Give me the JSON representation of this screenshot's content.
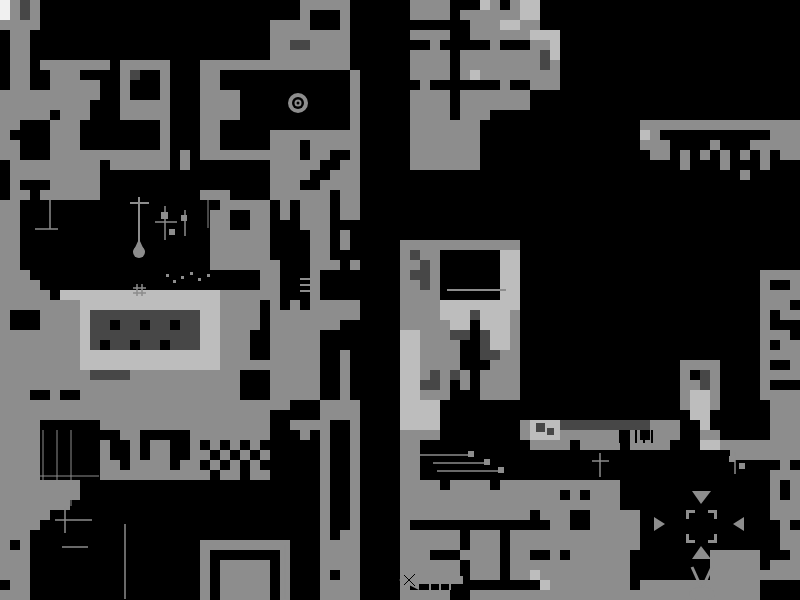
{
  "map": {
    "label": "monochrome game world map",
    "canvas_width": 800,
    "canvas_height": 600,
    "cell": 10,
    "palette": {
      ".": "#000000",
      "k": "#000000",
      "g": "#8d8d8d",
      "l": "#bdbdbd",
      "d": "#474747",
      "w": "#f0f0f0"
    },
    "grid": [
      "wgdg..........................ggggg......gggg...lg.gll..........................",
      "wgdg..........................g...g......gggg.ggggggll..........................",
      "gggg.......................gggg...g............gggllgg..........................",
      ".gg........................gggggggg......gggg..gggggglll........................",
      ".gg........................ggddgggg........g.....g...ggl........................",
      ".gg........................gggggggg......gggg.ggggggggdl........................",
      ".gg.ggggggg.ggggg...ggggggggggggggg......gggg.ggggggggdg........................",
      ".gg..ggg....gd..g...gg.............g.....gggg.glgggggggg........................",
      ".gg..ggggg..g...g...gg.............g......g.......g..ggg........................",
      "gggggggggg..g...g...gggg...........g.....gggg.ggggggg...........................",
      "ggggggggg...ggggg...gggg...........g.....gggg.ggggggg...........................",
      "ggggg.ggg...ggggg...gggg...........g.....gggg.ggg...............................",
      "gg...ggg........g...gg.............g.....ggggggg................gggggggggggggggg",
      "g....ggg........g...gg.....ggggggggg.....ggggggg................lg...........ggg",
      "gg...ggg........g...gg.....ggg.ggggg.....ggggggg................ggg....g...ggggg",
      "gg...gggggggggggg.g.gggggggggg.gg..g.....ggggggg.................gg.g.g.g.g.g.gg",
      ".ggggggggg.gggggg.g........ggggg..gg.....ggggggg....................g...g...g...",
      ".ggggggggg.................gggg..ggg......................................g.....",
      ".g...ggggg.................ggg..gggg............................................",
      ".gg.gggggg..........ggg....gggggg.gg............................................",
      "gg....................ggggg.g.ggg.gg............................................",
      "gg...................gg..gg.g.ggg.gg............................................",
      "gg...................gg..gg...ggg...............................................",
      "gg...................gggggg....gg.g.............................................",
      "gg...................gggggg....gg.g.....gggggggggggg............................",
      "gg...................gggggg....gg.......gdgg......ll............................",
      "gg...................ggggggg...ggg.g....ggdg......ll............................",
      "ggg.......................gg...g........gddg......ll........................gggg",
      "gggg......................gg...g........ggdg......ll........................g..g",
      "ggggg.llllllllllllllllgggggg...g........gggg......ll........................gggg",
      "ggggggggllllllllllllllgggg.g.g.ggggg....ggggllllllll........................ggg.",
      "g...ggggldddddddddddllgggg.ggggggggg....ggggllldlllg........................g.gg",
      "g...ggggldd.dd.dd.ddllgggg.ggggggg......gggggll.lllg........................g...",
      "ggggggggldddddddddddllggg..ggggg........llgggdd.dllg........................ggg.",
      "ggggggggld.dd.dd.dddllggg..ggggg........llgggg..dllg........................g.gg",
      "ggggggggllllllllllllllggg..ggggg..g.....llgggg..ddgg........................gggg",
      "ggggggggllllllllllllllgggggggggg..g.....llgggg...ggg................gggg....g..g",
      "gggggggggddddggggggggggg...ggggg..g.....llgdgdg.gggg................g.dg....gggg",
      "gggggggggggggggggggggggg...ggggg..g.....llddg.g.gggg................ggdg....g...",
      "ggg..g..gggggggggggggggg...ggggg..g.....llggg...gggg................gllg....gggg",
      "ggggggggggggggggggggggggggggg...gggg....llll........................gllg.....ggg",
      "ggggggggggggggggggggggggggg.....gggg....llll.........................ll......ggg",
      "gggg......ggggggggggggggggg..gggg..g....llll........gllldddddddddggg..l......ggg",
      "gggg........gg.....gggggggg...g.g..g....gggg........glllgggggg.g.ggg..gg.....ggg",
      "gggg......g..g.gg..g.g.g.g......g..g....gg...........gggg.gggg.gggg...llgggggggg",
      "gggg......g..g.gg..gg.g.g.g.....g..g....gg...............................ggggggg",
      "gggg......gg.gggg.gg.g.g.g......g..g....gg....................................g.",
      "gggg......ggggggggggg.gg.gg.....g..g....gg...................................ggg",
      "gggggggg........................g..g....gggg.gggg.gggggggggggg...............g.g",
      "gggggggg........................g..g....gggggggggggggggg.g.ggg...............g.g",
      "ggggggg.........................g..g....gggggggggggggggggggggg...............ggg",
      "ggggg...........................g..g....ggggggggggggg.ggg..ggggg.............ggg",
      "gggg............................g..g....g..............gg..ggggg..............g.",
      "ggg.............................g.gg....gggggg.ggg.ggggggggggggg..............gg",
      "g.g.................ggggggggg...gggg....gggggg.ggg.ggggggggggggg..............gg",
      "ggg.................g.......g...gggg....ggg...gggg.gg..g.gggggg........ggggg...g",
      "ggg.................g.ggggg.g...gggg....gggggg.ggg.gggggggggggg........ggggg.ggg",
      "ggg.................g.ggggg.g...g.gg....gggggg.ggg.gglggggggggg........ggggggggg",
      ".gg.................g.ggggg.g...gggg....g.............lgggggggg.gggggggggggg....",
      "ggg.................g.ggggg.g...gggg....ggggg..ggggggggggggggggggggggggggggg...."
    ],
    "features": [
      {
        "t": "circle",
        "cx": 298,
        "cy": 103,
        "r": 10,
        "c": "g"
      },
      {
        "t": "circle",
        "cx": 298,
        "cy": 103,
        "r": 6,
        "c": "k"
      },
      {
        "t": "circle",
        "cx": 298,
        "cy": 103,
        "r": 3.5,
        "c": "g"
      },
      {
        "t": "circle",
        "cx": 298,
        "cy": 103,
        "r": 1.5,
        "c": "k"
      },
      {
        "t": "line",
        "x1": 139,
        "y1": 197,
        "x2": 139,
        "y2": 244,
        "w": 2,
        "c": "g"
      },
      {
        "t": "line",
        "x1": 130,
        "y1": 203,
        "x2": 149,
        "y2": 203,
        "w": 2,
        "c": "g"
      },
      {
        "t": "tri",
        "p": [
          [
            139,
            239
          ],
          [
            133,
            252
          ],
          [
            145,
            252
          ]
        ],
        "c": "g"
      },
      {
        "t": "circle",
        "cx": 139,
        "cy": 252,
        "r": 6,
        "c": "g"
      },
      {
        "t": "line",
        "x1": 50,
        "y1": 200,
        "x2": 50,
        "y2": 229,
        "w": 1.5,
        "c": "g"
      },
      {
        "t": "line",
        "x1": 35,
        "y1": 229,
        "x2": 58,
        "y2": 229,
        "w": 1.5,
        "c": "g"
      },
      {
        "t": "line",
        "x1": 165,
        "y1": 206,
        "x2": 165,
        "y2": 240,
        "w": 1.5,
        "c": "g"
      },
      {
        "t": "line",
        "x1": 155,
        "y1": 222,
        "x2": 177,
        "y2": 222,
        "w": 1.5,
        "c": "g"
      },
      {
        "t": "rect",
        "x": 161,
        "y": 212,
        "wd": 7,
        "ht": 7,
        "c": "g"
      },
      {
        "t": "rect",
        "x": 169,
        "y": 229,
        "wd": 6,
        "ht": 6,
        "c": "g"
      },
      {
        "t": "line",
        "x1": 185,
        "y1": 210,
        "x2": 185,
        "y2": 236,
        "w": 1.5,
        "c": "g"
      },
      {
        "t": "rect",
        "x": 181,
        "y": 215,
        "wd": 6,
        "ht": 6,
        "c": "g"
      },
      {
        "t": "line",
        "x1": 208,
        "y1": 200,
        "x2": 208,
        "y2": 228,
        "w": 1,
        "c": "g"
      },
      {
        "t": "rect",
        "x": 166,
        "y": 274,
        "wd": 3,
        "ht": 3,
        "c": "g"
      },
      {
        "t": "rect",
        "x": 173,
        "y": 280,
        "wd": 3,
        "ht": 3,
        "c": "g"
      },
      {
        "t": "rect",
        "x": 181,
        "y": 276,
        "wd": 3,
        "ht": 3,
        "c": "g"
      },
      {
        "t": "rect",
        "x": 190,
        "y": 272,
        "wd": 3,
        "ht": 3,
        "c": "g"
      },
      {
        "t": "rect",
        "x": 198,
        "y": 278,
        "wd": 3,
        "ht": 3,
        "c": "g"
      },
      {
        "t": "rect",
        "x": 207,
        "y": 274,
        "wd": 3,
        "ht": 3,
        "c": "g"
      },
      {
        "t": "line",
        "x1": 137,
        "y1": 284,
        "x2": 137,
        "y2": 296,
        "w": 1.5,
        "c": "g"
      },
      {
        "t": "line",
        "x1": 142,
        "y1": 284,
        "x2": 142,
        "y2": 296,
        "w": 1.5,
        "c": "g"
      },
      {
        "t": "line",
        "x1": 133,
        "y1": 288,
        "x2": 146,
        "y2": 288,
        "w": 1.5,
        "c": "g"
      },
      {
        "t": "line",
        "x1": 133,
        "y1": 293,
        "x2": 146,
        "y2": 293,
        "w": 1.5,
        "c": "g"
      },
      {
        "t": "line",
        "x1": 300,
        "y1": 279,
        "x2": 317,
        "y2": 279,
        "w": 2,
        "c": "g"
      },
      {
        "t": "line",
        "x1": 300,
        "y1": 285,
        "x2": 317,
        "y2": 285,
        "w": 2,
        "c": "g"
      },
      {
        "t": "line",
        "x1": 300,
        "y1": 291,
        "x2": 317,
        "y2": 291,
        "w": 2,
        "c": "g"
      },
      {
        "t": "line",
        "x1": 447,
        "y1": 290,
        "x2": 506,
        "y2": 290,
        "w": 2,
        "c": "g"
      },
      {
        "t": "line",
        "x1": 420,
        "y1": 455,
        "x2": 470,
        "y2": 455,
        "w": 1.5,
        "c": "g"
      },
      {
        "t": "rect",
        "x": 468,
        "y": 451,
        "wd": 6,
        "ht": 6,
        "c": "g"
      },
      {
        "t": "line",
        "x1": 433,
        "y1": 463,
        "x2": 487,
        "y2": 463,
        "w": 1.5,
        "c": "g"
      },
      {
        "t": "rect",
        "x": 484,
        "y": 459,
        "wd": 6,
        "ht": 6,
        "c": "g"
      },
      {
        "t": "line",
        "x1": 437,
        "y1": 471,
        "x2": 502,
        "y2": 471,
        "w": 1.5,
        "c": "g"
      },
      {
        "t": "rect",
        "x": 498,
        "y": 467,
        "wd": 6,
        "ht": 6,
        "c": "g"
      },
      {
        "t": "line",
        "x1": 43,
        "y1": 430,
        "x2": 43,
        "y2": 506,
        "w": 1,
        "c": "g"
      },
      {
        "t": "line",
        "x1": 57,
        "y1": 430,
        "x2": 57,
        "y2": 509,
        "w": 1,
        "c": "g"
      },
      {
        "t": "line",
        "x1": 71,
        "y1": 430,
        "x2": 71,
        "y2": 506,
        "w": 1,
        "c": "g"
      },
      {
        "t": "line",
        "x1": 34,
        "y1": 476,
        "x2": 99,
        "y2": 476,
        "w": 1,
        "c": "g"
      },
      {
        "t": "line",
        "x1": 65,
        "y1": 506,
        "x2": 65,
        "y2": 533,
        "w": 1.5,
        "c": "g"
      },
      {
        "t": "line",
        "x1": 55,
        "y1": 520,
        "x2": 92,
        "y2": 520,
        "w": 1.5,
        "c": "g"
      },
      {
        "t": "line",
        "x1": 125,
        "y1": 524,
        "x2": 125,
        "y2": 599,
        "w": 1.5,
        "c": "g"
      },
      {
        "t": "line",
        "x1": 62,
        "y1": 547,
        "x2": 88,
        "y2": 547,
        "w": 1.5,
        "c": "g"
      },
      {
        "t": "line",
        "x1": 285,
        "y1": 545,
        "x2": 285,
        "y2": 599,
        "w": 1.5,
        "c": "g"
      },
      {
        "t": "tri",
        "p": [
          [
            692,
            491
          ],
          [
            711,
            491
          ],
          [
            701,
            504
          ]
        ],
        "c": "g"
      },
      {
        "t": "tri",
        "p": [
          [
            654,
            517
          ],
          [
            654,
            531
          ],
          [
            665,
            524
          ]
        ],
        "c": "g"
      },
      {
        "t": "tri",
        "p": [
          [
            744,
            517
          ],
          [
            744,
            531
          ],
          [
            733,
            524
          ]
        ],
        "c": "g"
      },
      {
        "t": "tri",
        "p": [
          [
            692,
            559
          ],
          [
            711,
            559
          ],
          [
            701,
            546
          ]
        ],
        "c": "g"
      },
      {
        "t": "rect",
        "x": 686,
        "y": 510,
        "wd": 9,
        "ht": 3,
        "c": "g"
      },
      {
        "t": "rect",
        "x": 686,
        "y": 510,
        "wd": 3,
        "ht": 9,
        "c": "g"
      },
      {
        "t": "rect",
        "x": 708,
        "y": 510,
        "wd": 9,
        "ht": 3,
        "c": "g"
      },
      {
        "t": "rect",
        "x": 714,
        "y": 510,
        "wd": 3,
        "ht": 9,
        "c": "g"
      },
      {
        "t": "rect",
        "x": 686,
        "y": 540,
        "wd": 9,
        "ht": 3,
        "c": "g"
      },
      {
        "t": "rect",
        "x": 686,
        "y": 534,
        "wd": 3,
        "ht": 9,
        "c": "g"
      },
      {
        "t": "rect",
        "x": 708,
        "y": 540,
        "wd": 9,
        "ht": 3,
        "c": "g"
      },
      {
        "t": "rect",
        "x": 714,
        "y": 534,
        "wd": 3,
        "ht": 9,
        "c": "g"
      },
      {
        "t": "line",
        "x1": 692,
        "y1": 567,
        "x2": 702,
        "y2": 589,
        "w": 3,
        "c": "g"
      },
      {
        "t": "line",
        "x1": 712,
        "y1": 567,
        "x2": 702,
        "y2": 589,
        "w": 3,
        "c": "g"
      },
      {
        "t": "ellipse",
        "cx": 702,
        "cy": 594,
        "rx": 13,
        "ry": 7,
        "c": "g"
      },
      {
        "t": "tri",
        "p": [
          [
            399,
            580
          ],
          [
            419,
            570
          ],
          [
            419,
            590
          ]
        ],
        "c": "g"
      },
      {
        "t": "rect",
        "x": 419,
        "y": 576,
        "wd": 44,
        "ht": 8,
        "c": "g"
      },
      {
        "t": "line",
        "x1": 430,
        "y1": 570,
        "x2": 430,
        "y2": 590,
        "w": 2,
        "c": "g"
      },
      {
        "t": "line",
        "x1": 440,
        "y1": 570,
        "x2": 440,
        "y2": 590,
        "w": 2,
        "c": "g"
      },
      {
        "t": "line",
        "x1": 450,
        "y1": 570,
        "x2": 450,
        "y2": 590,
        "w": 2,
        "c": "g"
      },
      {
        "t": "line",
        "x1": 404,
        "y1": 575,
        "x2": 415,
        "y2": 586,
        "w": 1,
        "c": "k"
      },
      {
        "t": "line",
        "x1": 404,
        "y1": 585,
        "x2": 415,
        "y2": 574,
        "w": 1,
        "c": "k"
      },
      {
        "t": "rect",
        "x": 536,
        "y": 423,
        "wd": 9,
        "ht": 9,
        "c": "d"
      },
      {
        "t": "rect",
        "x": 547,
        "y": 428,
        "wd": 7,
        "ht": 7,
        "c": "d"
      },
      {
        "t": "line",
        "x1": 620,
        "y1": 430,
        "x2": 620,
        "y2": 443,
        "w": 2,
        "c": "k"
      },
      {
        "t": "line",
        "x1": 628,
        "y1": 430,
        "x2": 628,
        "y2": 443,
        "w": 2,
        "c": "k"
      },
      {
        "t": "line",
        "x1": 636,
        "y1": 430,
        "x2": 636,
        "y2": 443,
        "w": 2,
        "c": "k"
      },
      {
        "t": "line",
        "x1": 644,
        "y1": 430,
        "x2": 644,
        "y2": 443,
        "w": 2,
        "c": "k"
      },
      {
        "t": "line",
        "x1": 652,
        "y1": 430,
        "x2": 652,
        "y2": 443,
        "w": 2,
        "c": "k"
      },
      {
        "t": "line",
        "x1": 600,
        "y1": 453,
        "x2": 600,
        "y2": 477,
        "w": 1.5,
        "c": "g"
      },
      {
        "t": "line",
        "x1": 592,
        "y1": 461,
        "x2": 609,
        "y2": 461,
        "w": 1.5,
        "c": "g"
      },
      {
        "t": "line",
        "x1": 735,
        "y1": 452,
        "x2": 735,
        "y2": 474,
        "w": 1.5,
        "c": "g"
      },
      {
        "t": "rect",
        "x": 729,
        "y": 456,
        "wd": 6,
        "ht": 6,
        "c": "g"
      },
      {
        "t": "rect",
        "x": 739,
        "y": 463,
        "wd": 6,
        "ht": 6,
        "c": "g"
      }
    ]
  }
}
